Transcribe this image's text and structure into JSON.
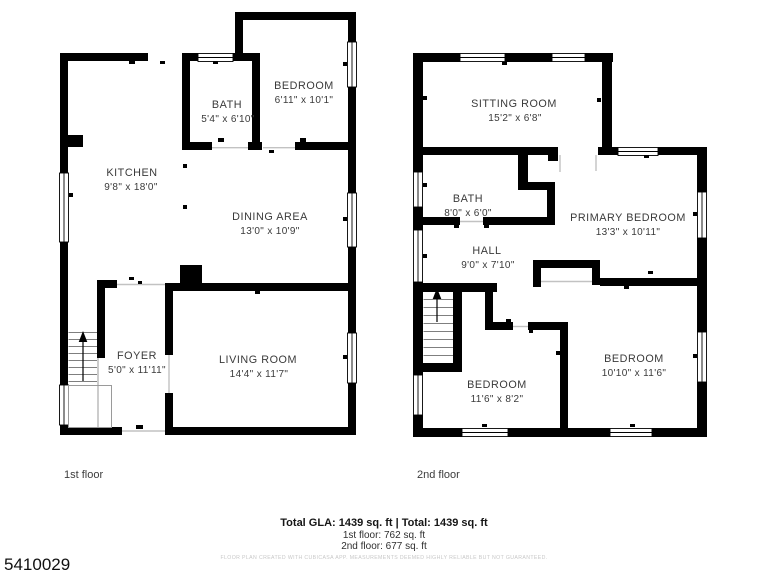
{
  "title": "Two-floor residential floor plan",
  "colors": {
    "wall": "#000000",
    "room_text": "#3a3a3a",
    "summary_text": "#161616",
    "disclaimer_text": "#c8c8c8",
    "background": "#ffffff"
  },
  "floors": [
    {
      "label": "1st floor",
      "rooms": [
        {
          "name": "BEDROOM",
          "dims": "6'11\" x 10'1\""
        },
        {
          "name": "BATH",
          "dims": "5'4\" x 6'10\""
        },
        {
          "name": "KITCHEN",
          "dims": "9'8\" x 18'0\""
        },
        {
          "name": "DINING AREA",
          "dims": "13'0\" x 10'9\""
        },
        {
          "name": "FOYER",
          "dims": "5'0\" x 11'11\""
        },
        {
          "name": "LIVING ROOM",
          "dims": "14'4\" x 11'7\""
        }
      ]
    },
    {
      "label": "2nd floor",
      "rooms": [
        {
          "name": "SITTING ROOM",
          "dims": "15'2\" x 6'8\""
        },
        {
          "name": "BATH",
          "dims": "8'0\" x 6'0\""
        },
        {
          "name": "PRIMARY BEDROOM",
          "dims": "13'3\" x 10'11\""
        },
        {
          "name": "HALL",
          "dims": "9'0\" x 7'10\""
        },
        {
          "name": "BEDROOM",
          "dims": "11'6\" x 8'2\""
        },
        {
          "name": "BEDROOM",
          "dims": "10'10\" x 11'6\""
        }
      ]
    }
  ],
  "summary": {
    "total_line": "Total GLA: 1439 sq. ft | Total: 1439 sq. ft",
    "first_floor_line": "1st floor: 762 sq. ft",
    "second_floor_line": "2nd floor: 677 sq. ft",
    "disclaimer": "FLOOR PLAN CREATED WITH CUBICASA APP. MEASUREMENTS DEEMED HIGHLY RELIABLE BUT NOT GUARANTEED."
  },
  "listing_id": "5410029"
}
